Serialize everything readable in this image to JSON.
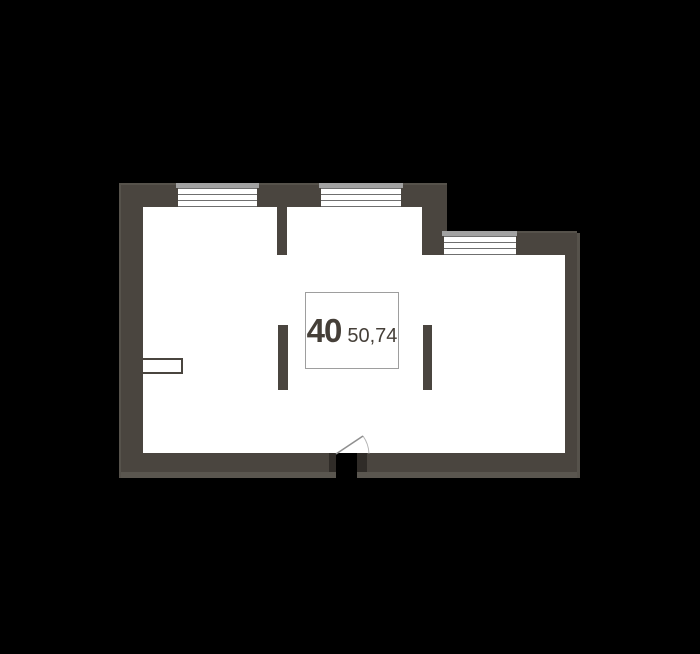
{
  "floor_plan": {
    "unit_number": "40",
    "area": "50,74",
    "colors": {
      "bg": "#000000",
      "wall": "#4a453f",
      "bevel": "#56524b",
      "outer": "#5a564f",
      "sill": "#a2a2a2",
      "winline": "#6f6f6f",
      "interior": "#ffffff",
      "labelborder": "#9e9e9e",
      "text": "#453f38",
      "jamb": "#302c28",
      "doorline": "#8f8f8f",
      "doorarc": "#b5b5b5"
    }
  }
}
